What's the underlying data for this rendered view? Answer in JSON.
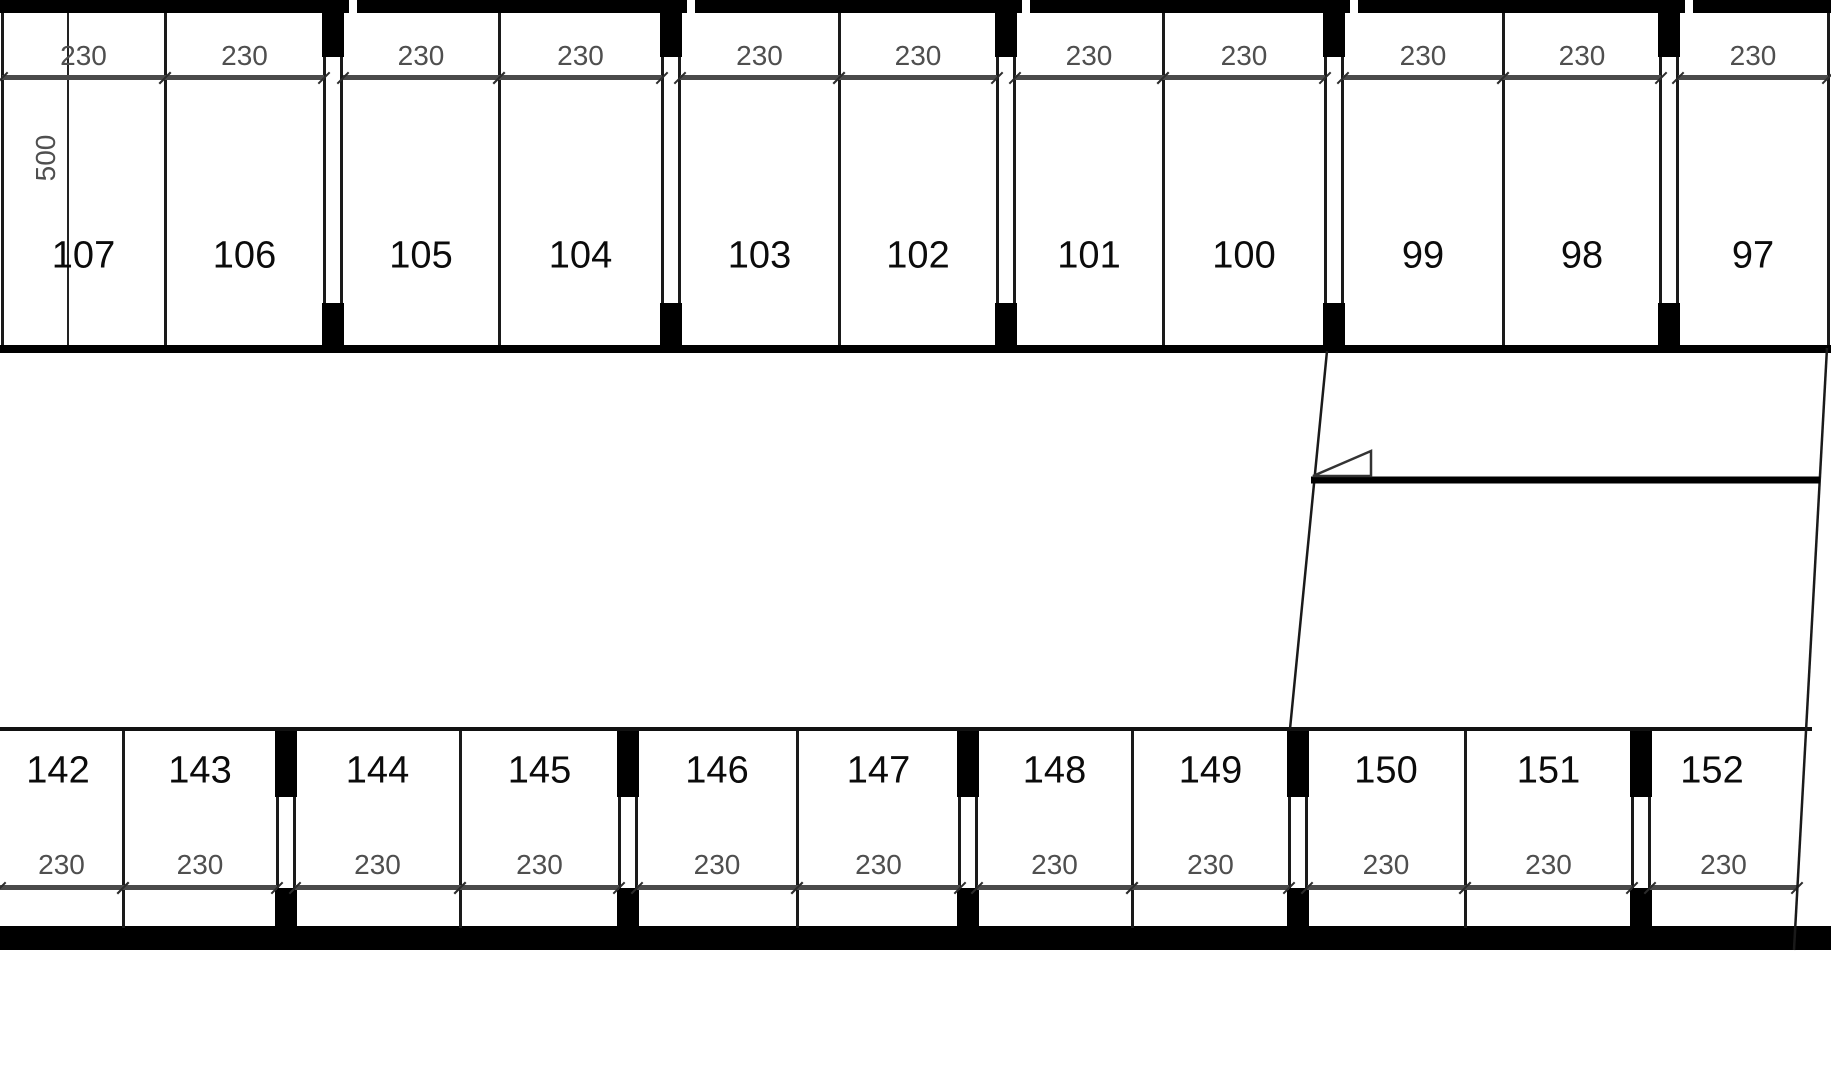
{
  "title": "Parking garage floor plan — stalls 97-107 and 142-152",
  "colors": {
    "wall": "#000000",
    "thin_line": "#1a1a1a",
    "dimension_line": "#4a4a4a",
    "dimension_text": "#4f4f4f",
    "stall_number": "#0b0b0b",
    "background": "#ffffff"
  },
  "plan": {
    "depth_dimension": {
      "label": "500"
    },
    "rows": [
      {
        "id": "top",
        "stalls": [
          {
            "num": "107",
            "dim": "230",
            "x1": 2,
            "x2": 165
          },
          {
            "num": "106",
            "dim": "230",
            "x1": 165,
            "x2": 324
          },
          {
            "num": "105",
            "dim": "230",
            "x1": 343,
            "x2": 499
          },
          {
            "num": "104",
            "dim": "230",
            "x1": 499,
            "x2": 662
          },
          {
            "num": "103",
            "dim": "230",
            "x1": 680,
            "x2": 839
          },
          {
            "num": "102",
            "dim": "230",
            "x1": 839,
            "x2": 997
          },
          {
            "num": "101",
            "dim": "230",
            "x1": 1015,
            "x2": 1163
          },
          {
            "num": "100",
            "dim": "230",
            "x1": 1163,
            "x2": 1325
          },
          {
            "num": "99",
            "dim": "230",
            "x1": 1343,
            "x2": 1503
          },
          {
            "num": "98",
            "dim": "230",
            "x1": 1503,
            "x2": 1661
          },
          {
            "num": "97",
            "dim": "230",
            "x1": 1678,
            "x2": 1828
          }
        ],
        "thin_dividers": [
          2,
          165,
          499,
          839,
          1163,
          1503,
          1828
        ],
        "double_walls": [
          333,
          671,
          1006,
          1334,
          1669
        ]
      },
      {
        "id": "bottom",
        "stalls": [
          {
            "num": "142",
            "dim": "230",
            "x1": 0,
            "x2": 123,
            "label_x": 58
          },
          {
            "num": "143",
            "dim": "230",
            "x1": 123,
            "x2": 277
          },
          {
            "num": "144",
            "dim": "230",
            "x1": 295,
            "x2": 460
          },
          {
            "num": "145",
            "dim": "230",
            "x1": 460,
            "x2": 619
          },
          {
            "num": "146",
            "dim": "230",
            "x1": 637,
            "x2": 797
          },
          {
            "num": "147",
            "dim": "230",
            "x1": 797,
            "x2": 960
          },
          {
            "num": "148",
            "dim": "230",
            "x1": 977,
            "x2": 1132
          },
          {
            "num": "149",
            "dim": "230",
            "x1": 1132,
            "x2": 1289
          },
          {
            "num": "150",
            "dim": "230",
            "x1": 1307,
            "x2": 1465
          },
          {
            "num": "151",
            "dim": "230",
            "x1": 1465,
            "x2": 1632
          },
          {
            "num": "152",
            "dim": "230",
            "x1": 1650,
            "x2": 1797,
            "label_x": 1712
          }
        ],
        "thin_dividers": [
          123,
          460,
          797,
          1132,
          1465
        ],
        "double_walls": [
          286,
          628,
          968,
          1298,
          1641
        ]
      }
    ]
  }
}
